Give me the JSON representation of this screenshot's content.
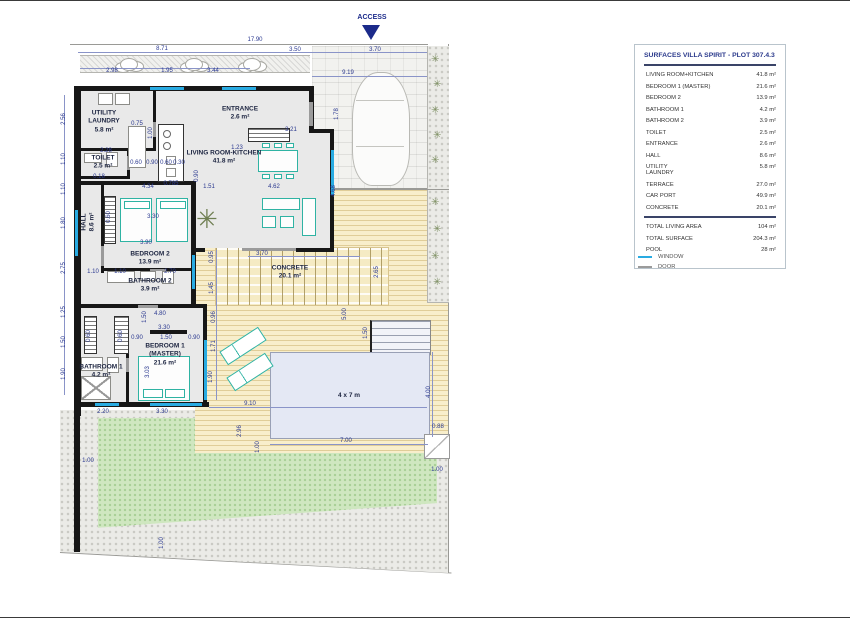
{
  "access": {
    "label": "ACCESS"
  },
  "legend_panel": {
    "title": "SURFACES VILLA SPIRIT - PLOT 307.4.3",
    "rows": [
      {
        "label": "LIVING ROOM+KITCHEN",
        "value": "41.8 m²"
      },
      {
        "label": "BEDROOM 1 (MASTER)",
        "value": "21.6 m²"
      },
      {
        "label": "BEDROOM 2",
        "value": "13.9 m²"
      },
      {
        "label": "BATHROOM 1",
        "value": "4.2 m²"
      },
      {
        "label": "BATHROOM 2",
        "value": "3.9 m²"
      },
      {
        "label": "TOILET",
        "value": "2.5 m²"
      },
      {
        "label": "ENTRANCE",
        "value": "2.6 m²"
      },
      {
        "label": "HALL",
        "value": "8.6 m²"
      },
      {
        "label": "UTILITY\nLAUNDRY",
        "value": "5.8 m²"
      },
      {
        "label": "TERRACE",
        "value": "27.0 m²"
      },
      {
        "label": "CAR PORT",
        "value": "49.9 m²"
      },
      {
        "label": "CONCRETE",
        "value": "20.1 m²"
      }
    ],
    "totals": [
      {
        "label": "TOTAL LIVING AREA",
        "value": "104 m²"
      },
      {
        "label": "TOTAL SURFACE",
        "value": "204.3 m²"
      },
      {
        "label": "POOL",
        "value": "28 m²"
      }
    ]
  },
  "symbol_legend": {
    "window": {
      "label": "WINDOW",
      "color": "#29abe2"
    },
    "door": {
      "label": "DOOR",
      "color": "#9b9b9b"
    }
  },
  "plan": {
    "colors": {
      "wall": "#171717",
      "window": "#29abe2",
      "door": "#9b9b9b",
      "furniture": "#2fb3a3",
      "dimension_text": "#2b3990"
    },
    "room_labels": [
      {
        "name": "utility-laundry",
        "lines": [
          "UTILITY",
          "LAUNDRY",
          "5.8 m²"
        ],
        "x": 104,
        "y": 122
      },
      {
        "name": "toilet",
        "lines": [
          "TOILET",
          "2.5 m²"
        ],
        "x": 103,
        "y": 163
      },
      {
        "name": "entrance",
        "lines": [
          "ENTRANCE",
          "2.6 m²"
        ],
        "x": 240,
        "y": 114
      },
      {
        "name": "living-room-kitchen",
        "lines": [
          "LIVING ROOM-KITCHEN",
          "41.8 m²"
        ],
        "x": 224,
        "y": 158
      },
      {
        "name": "hall",
        "lines": [
          "HALL",
          "8.6 m²"
        ],
        "x": 89,
        "y": 222,
        "v": true
      },
      {
        "name": "bedroom-2",
        "lines": [
          "BEDROOM 2",
          "13.9 m²"
        ],
        "x": 150,
        "y": 259
      },
      {
        "name": "bathroom-2",
        "lines": [
          "BATHROOM 2",
          "3.9 m²"
        ],
        "x": 150,
        "y": 286
      },
      {
        "name": "bedroom-1-master",
        "lines": [
          "BEDROOM 1",
          "(MASTER)",
          "21.6 m²"
        ],
        "x": 165,
        "y": 355
      },
      {
        "name": "bathroom-1",
        "lines": [
          "BATHROOM 1",
          "4.2 m²"
        ],
        "x": 101,
        "y": 372
      },
      {
        "name": "concrete",
        "lines": [
          "CONCRETE",
          "20.1 m²"
        ],
        "x": 290,
        "y": 273
      },
      {
        "name": "pool-size",
        "lines": [
          "4 x 7 m"
        ],
        "x": 349,
        "y": 396
      }
    ],
    "dims": [
      {
        "t": "17.90",
        "x": 255,
        "y": 40
      },
      {
        "t": "8.71",
        "x": 162,
        "y": 49
      },
      {
        "t": "3.50",
        "x": 295,
        "y": 50
      },
      {
        "t": "3.70",
        "x": 375,
        "y": 50
      },
      {
        "t": "2.98",
        "x": 112,
        "y": 71
      },
      {
        "t": "1.95",
        "x": 167,
        "y": 71
      },
      {
        "t": "3.44",
        "x": 213,
        "y": 71
      },
      {
        "t": "9.19",
        "x": 348,
        "y": 73
      },
      {
        "t": "1.78",
        "x": 337,
        "y": 114,
        "v": true
      },
      {
        "t": "4.68",
        "x": 334,
        "y": 191,
        "v": true
      },
      {
        "t": "3.21",
        "x": 291,
        "y": 130
      },
      {
        "t": "1.23",
        "x": 237,
        "y": 148
      },
      {
        "t": "0.75",
        "x": 137,
        "y": 124
      },
      {
        "t": "1.00",
        "x": 151,
        "y": 133,
        "v": true
      },
      {
        "t": "2.28",
        "x": 106,
        "y": 151
      },
      {
        "t": "0.60",
        "x": 136,
        "y": 163
      },
      {
        "t": "0.90",
        "x": 152,
        "y": 163
      },
      {
        "t": "0.60",
        "x": 166,
        "y": 163
      },
      {
        "t": "0.30",
        "x": 179,
        "y": 163
      },
      {
        "t": "0.18",
        "x": 99,
        "y": 177
      },
      {
        "t": "4.34",
        "x": 148,
        "y": 187
      },
      {
        "t": "0.785",
        "x": 171,
        "y": 184
      },
      {
        "t": "1.51",
        "x": 209,
        "y": 187
      },
      {
        "t": "4.62",
        "x": 274,
        "y": 187
      },
      {
        "t": "0.90",
        "x": 197,
        "y": 176,
        "v": true
      },
      {
        "t": "2.56",
        "x": 64,
        "y": 119,
        "v": true
      },
      {
        "t": "1.10",
        "x": 64,
        "y": 159,
        "v": true
      },
      {
        "t": "1.10",
        "x": 64,
        "y": 189,
        "v": true
      },
      {
        "t": "1.80",
        "x": 64,
        "y": 223,
        "v": true
      },
      {
        "t": "2.75",
        "x": 64,
        "y": 268,
        "v": true
      },
      {
        "t": "1.25",
        "x": 64,
        "y": 312,
        "v": true
      },
      {
        "t": "1.50",
        "x": 64,
        "y": 342,
        "v": true
      },
      {
        "t": "1.90",
        "x": 64,
        "y": 374,
        "v": true
      },
      {
        "t": "1.10",
        "x": 93,
        "y": 272
      },
      {
        "t": "1.10",
        "x": 120,
        "y": 272
      },
      {
        "t": "2.70",
        "x": 170,
        "y": 272
      },
      {
        "t": "3.30",
        "x": 153,
        "y": 217
      },
      {
        "t": "3.90",
        "x": 146,
        "y": 243
      },
      {
        "t": "0.60",
        "x": 109,
        "y": 217,
        "v": true
      },
      {
        "t": "3.70",
        "x": 262,
        "y": 254
      },
      {
        "t": "0.95",
        "x": 212,
        "y": 257,
        "v": true
      },
      {
        "t": "1.45",
        "x": 212,
        "y": 288,
        "v": true
      },
      {
        "t": "2.65",
        "x": 377,
        "y": 272,
        "v": true
      },
      {
        "t": "5.00",
        "x": 345,
        "y": 314,
        "v": true
      },
      {
        "t": "0.96",
        "x": 214,
        "y": 317,
        "v": true
      },
      {
        "t": "1.71",
        "x": 214,
        "y": 346,
        "v": true
      },
      {
        "t": "1.90",
        "x": 211,
        "y": 377,
        "v": true
      },
      {
        "t": "1.50",
        "x": 366,
        "y": 333,
        "v": true
      },
      {
        "t": "4.80",
        "x": 160,
        "y": 314
      },
      {
        "t": "1.50",
        "x": 145,
        "y": 317,
        "v": true
      },
      {
        "t": "3.30",
        "x": 164,
        "y": 328
      },
      {
        "t": "0.90",
        "x": 137,
        "y": 338
      },
      {
        "t": "1.50",
        "x": 166,
        "y": 338
      },
      {
        "t": "0.90",
        "x": 194,
        "y": 338
      },
      {
        "t": "3.03",
        "x": 148,
        "y": 372,
        "v": true
      },
      {
        "t": "0.60",
        "x": 89,
        "y": 336,
        "v": true
      },
      {
        "t": "0.60",
        "x": 121,
        "y": 336,
        "v": true
      },
      {
        "t": "2.20",
        "x": 103,
        "y": 412
      },
      {
        "t": "3.30",
        "x": 162,
        "y": 412
      },
      {
        "t": "9.10",
        "x": 250,
        "y": 404
      },
      {
        "t": "1.00",
        "x": 88,
        "y": 461
      },
      {
        "t": "1.00",
        "x": 162,
        "y": 543,
        "v": true
      },
      {
        "t": "2.96",
        "x": 240,
        "y": 431,
        "v": true
      },
      {
        "t": "1.00",
        "x": 258,
        "y": 447,
        "v": true
      },
      {
        "t": "7.00",
        "x": 346,
        "y": 441
      },
      {
        "t": "0.88",
        "x": 438,
        "y": 427
      },
      {
        "t": "4.00",
        "x": 429,
        "y": 392,
        "v": true
      },
      {
        "t": "1.00",
        "x": 437,
        "y": 470
      }
    ]
  }
}
